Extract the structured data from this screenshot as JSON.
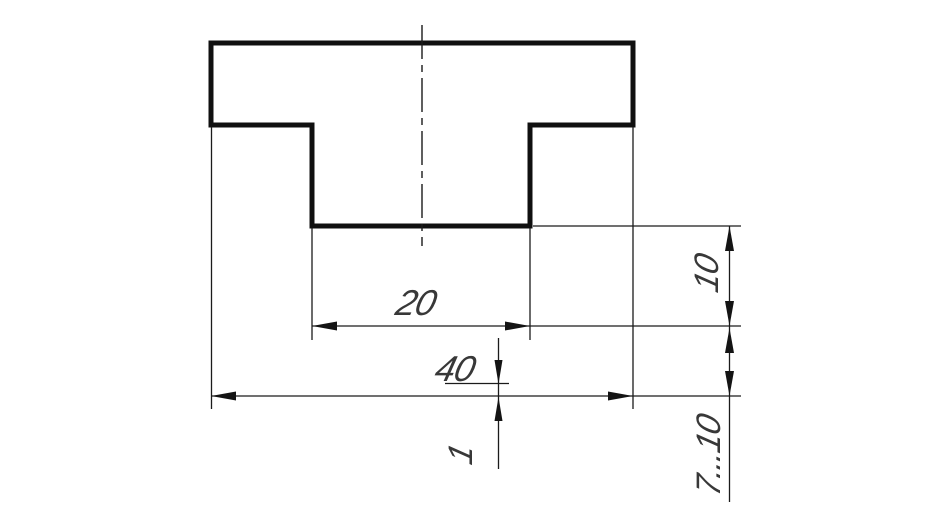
{
  "drawing": {
    "description": "Technical drawing of a T-shaped profile cross-section with dimensioning example",
    "labels": {
      "slot_width": "20",
      "overall_width": "40",
      "gap": "1",
      "contour_offset": "10",
      "line_spacing": "7...10"
    },
    "colors": {
      "outline": "#101010",
      "thin_line": "#1b1b1b",
      "text": "#383838",
      "background": "#ffffff"
    }
  }
}
